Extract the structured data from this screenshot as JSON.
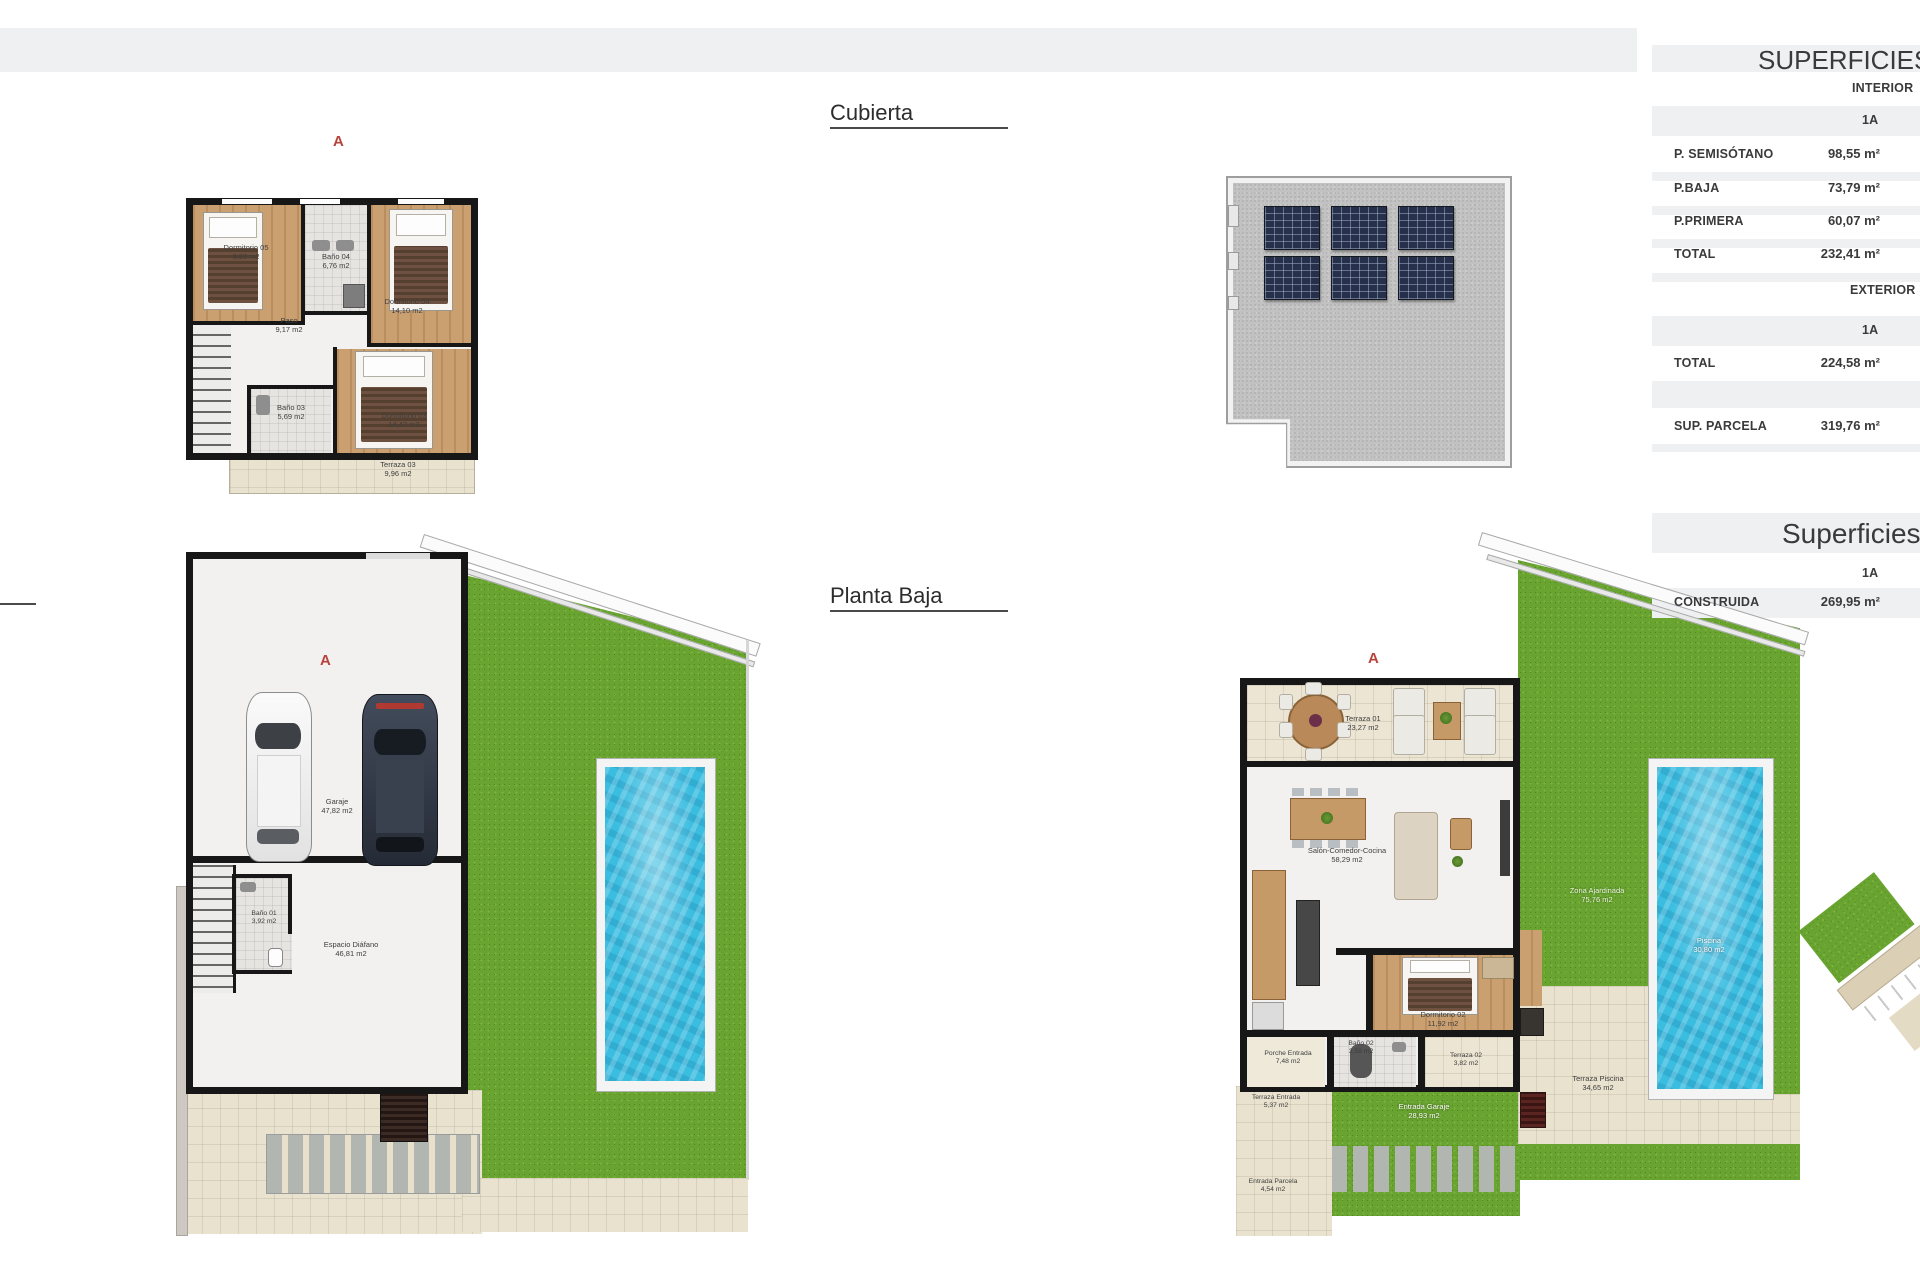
{
  "document": {
    "plan_labels": {
      "cubierta": "Cubierta",
      "planta_baja": "Planta Baja"
    }
  },
  "colors": {
    "marker_red": "#b8433c",
    "table_band_gray": "#eef0f1",
    "grass_green": "#69a430",
    "pool_blue": "#3bbde0",
    "wall_black": "#171717",
    "wood_floor": "#cba070",
    "terrace_tile": "#e9e2cf",
    "roof_gray": "#c2c2c2",
    "solar_panel": "#27304a"
  },
  "tables": {
    "superficies": {
      "title": "SUPERFICIES",
      "interior_header": "INTERIOR",
      "exterior_header": "EXTERIOR",
      "unit_column": "1A",
      "interior_rows": [
        {
          "label": "P. SEMISÓTANO",
          "value": "98,55 m²"
        },
        {
          "label": "P.BAJA",
          "value": "73,79 m²"
        },
        {
          "label": "P.PRIMERA",
          "value": "60,07 m²"
        },
        {
          "label": "TOTAL",
          "value": "232,41 m²"
        }
      ],
      "exterior_rows": [
        {
          "label": "TOTAL",
          "value": "224,58 m²"
        },
        {
          "label": "SUP. PARCELA",
          "value": "319,76 m²"
        }
      ]
    },
    "superficies_construida": {
      "title": "Superficies",
      "unit_column": "1A",
      "rows": [
        {
          "label": "CONSTRUIDA",
          "value": "269,95 m²"
        }
      ]
    }
  },
  "plans": {
    "planta_primera": {
      "marker": "A",
      "rooms": [
        {
          "name": "Dormitorio 05",
          "area": "9,93 m2"
        },
        {
          "name": "Baño 04",
          "area": "6,76 m2"
        },
        {
          "name": "Dormitorio 04",
          "area": "14,10 m2"
        },
        {
          "name": "Paso",
          "area": "9,17 m2"
        },
        {
          "name": "Baño 03",
          "area": "5,69 m2"
        },
        {
          "name": "Dormitorio 03",
          "area": "14,42 m2"
        },
        {
          "name": "Terraza 03",
          "area": "9,96 m2"
        }
      ]
    },
    "cubierta": {},
    "planta_semisotano": {
      "marker": "A",
      "rooms": [
        {
          "name": "Garaje",
          "area": "47,82 m2"
        },
        {
          "name": "Baño 01",
          "area": "3,92 m2"
        },
        {
          "name": "Espacio Diáfano",
          "area": "46,81 m2"
        }
      ]
    },
    "planta_baja": {
      "marker": "A",
      "rooms": [
        {
          "name": "Terraza 01",
          "area": "23,27 m2"
        },
        {
          "name": "Salón-Comedor-Cocina",
          "area": "58,29 m2"
        },
        {
          "name": "Dormitorio 02",
          "area": "11,92 m2"
        },
        {
          "name": "Baño 02",
          "area": "3,58 m2"
        },
        {
          "name": "Terraza 02",
          "area": "3,82 m2"
        },
        {
          "name": "Porche Entrada",
          "area": "7,48 m2"
        },
        {
          "name": "Terraza Entrada",
          "area": "5,37 m2"
        },
        {
          "name": "Entrada Parcela",
          "area": "4,54 m2"
        },
        {
          "name": "Entrada Garaje",
          "area": "28,93 m2"
        },
        {
          "name": "Terraza Piscina",
          "area": "34,65 m2"
        },
        {
          "name": "Piscina",
          "area": "30,80 m2"
        },
        {
          "name": "Zona Ajardinada",
          "area": "75,76 m2"
        }
      ]
    }
  }
}
